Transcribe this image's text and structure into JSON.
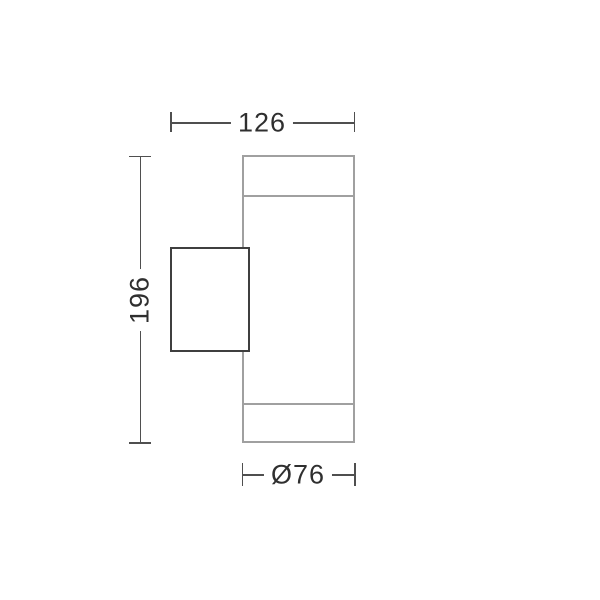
{
  "drawing": {
    "labels": {
      "width": "126",
      "height": "196",
      "diameter": "Ø76"
    },
    "colors": {
      "background": "#ffffff",
      "body-stroke": "#a0a0a0",
      "bracket-stroke": "#3f3f3f",
      "dimension-stroke": "#4f4f4f",
      "text": "#2f2f2f"
    }
  }
}
